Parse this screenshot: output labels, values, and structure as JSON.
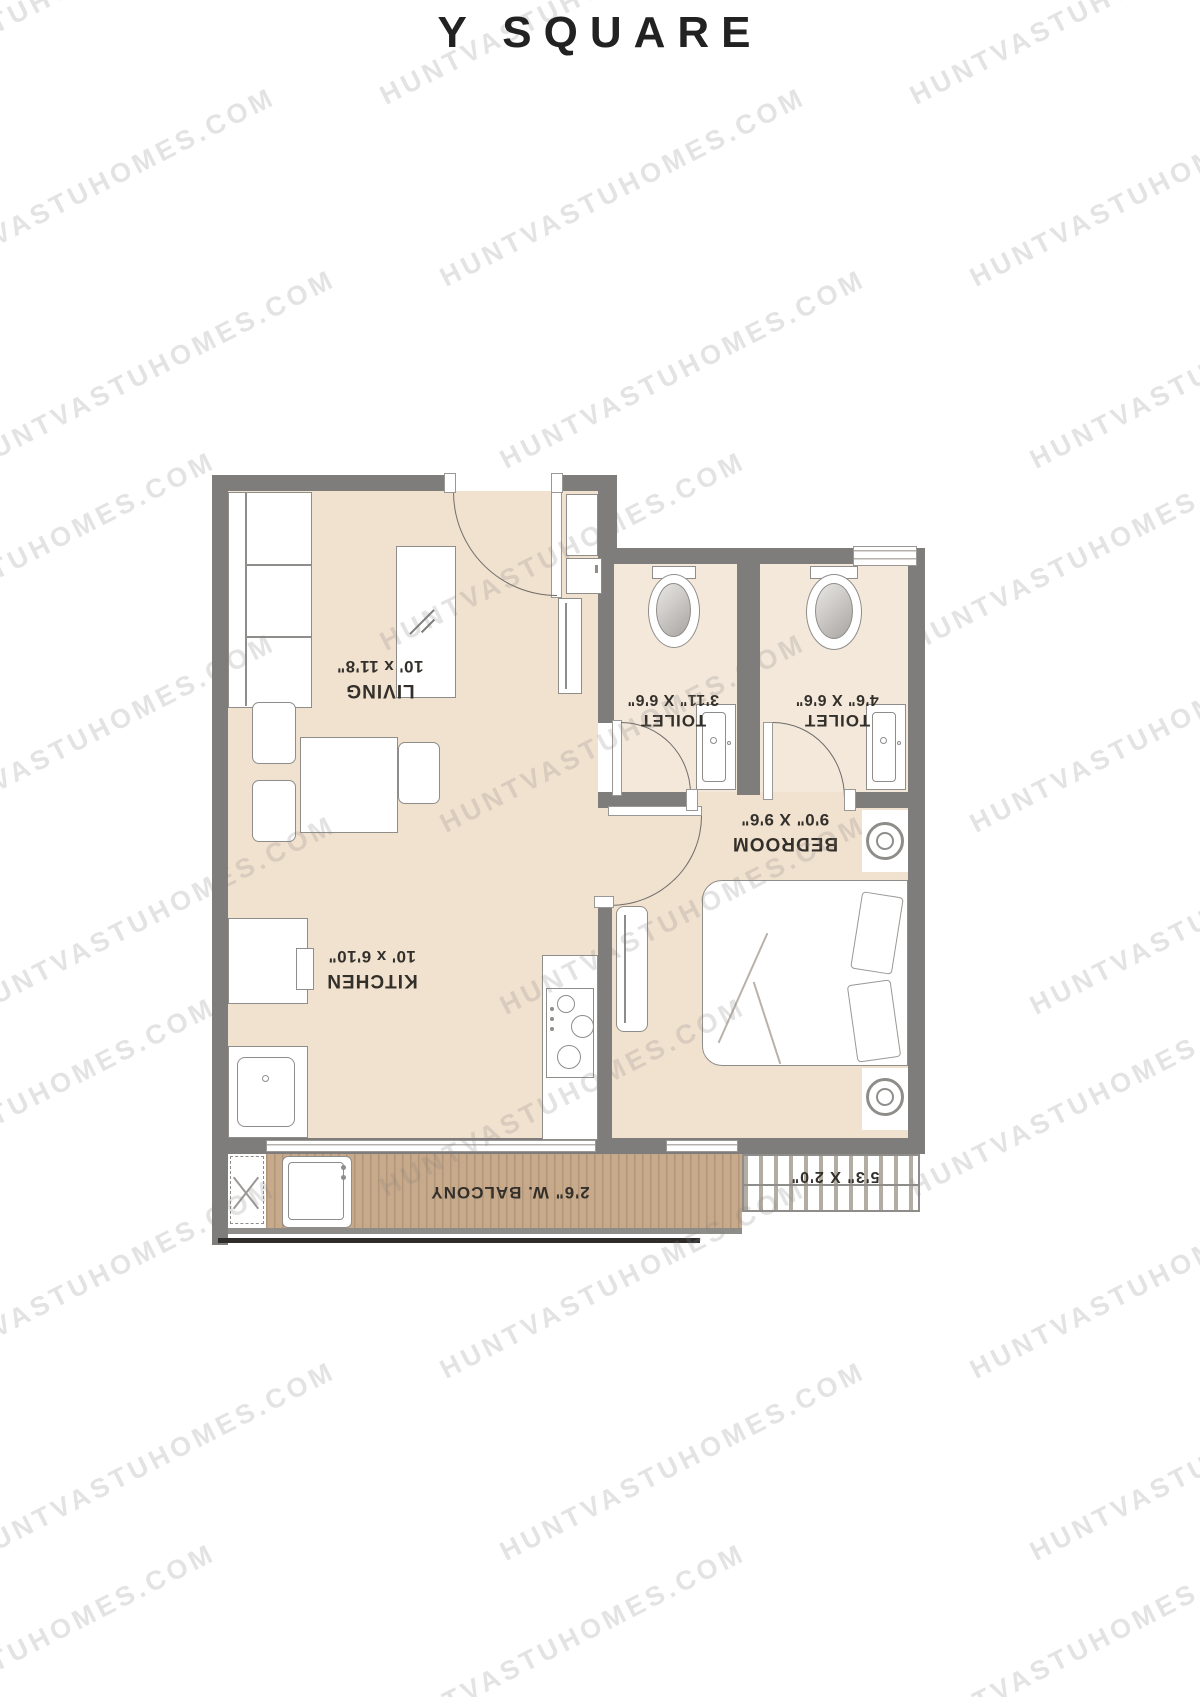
{
  "title": "Y SQUARE",
  "watermark": {
    "text": "HUNTVASTUHOMES.COM"
  },
  "colors": {
    "wall": "#7e7d7b",
    "floor": "#f1e2d0",
    "toilet_floor": "#f3e8da",
    "balcony_wood": "#c7aa8c",
    "label_text": "#332f2a",
    "title_text": "#222222"
  },
  "rooms": {
    "living": {
      "name": "LIVING",
      "dims": "10' x 11'8\""
    },
    "kitchen": {
      "name": "KITCHEN",
      "dims": "10' x 6'10\""
    },
    "bedroom": {
      "name": "BEDROOM",
      "dims": "9'0\" X 9'6\""
    },
    "toilet1": {
      "name": "TOILET",
      "dims": "3'11\" X 6'6\""
    },
    "toilet2": {
      "name": "TOILET",
      "dims": "4'6\" X 6'6\""
    },
    "balcony": {
      "name": "2'6\" W. BALCONY"
    },
    "ledge": {
      "name": "5'3\" X 2'0\""
    }
  }
}
